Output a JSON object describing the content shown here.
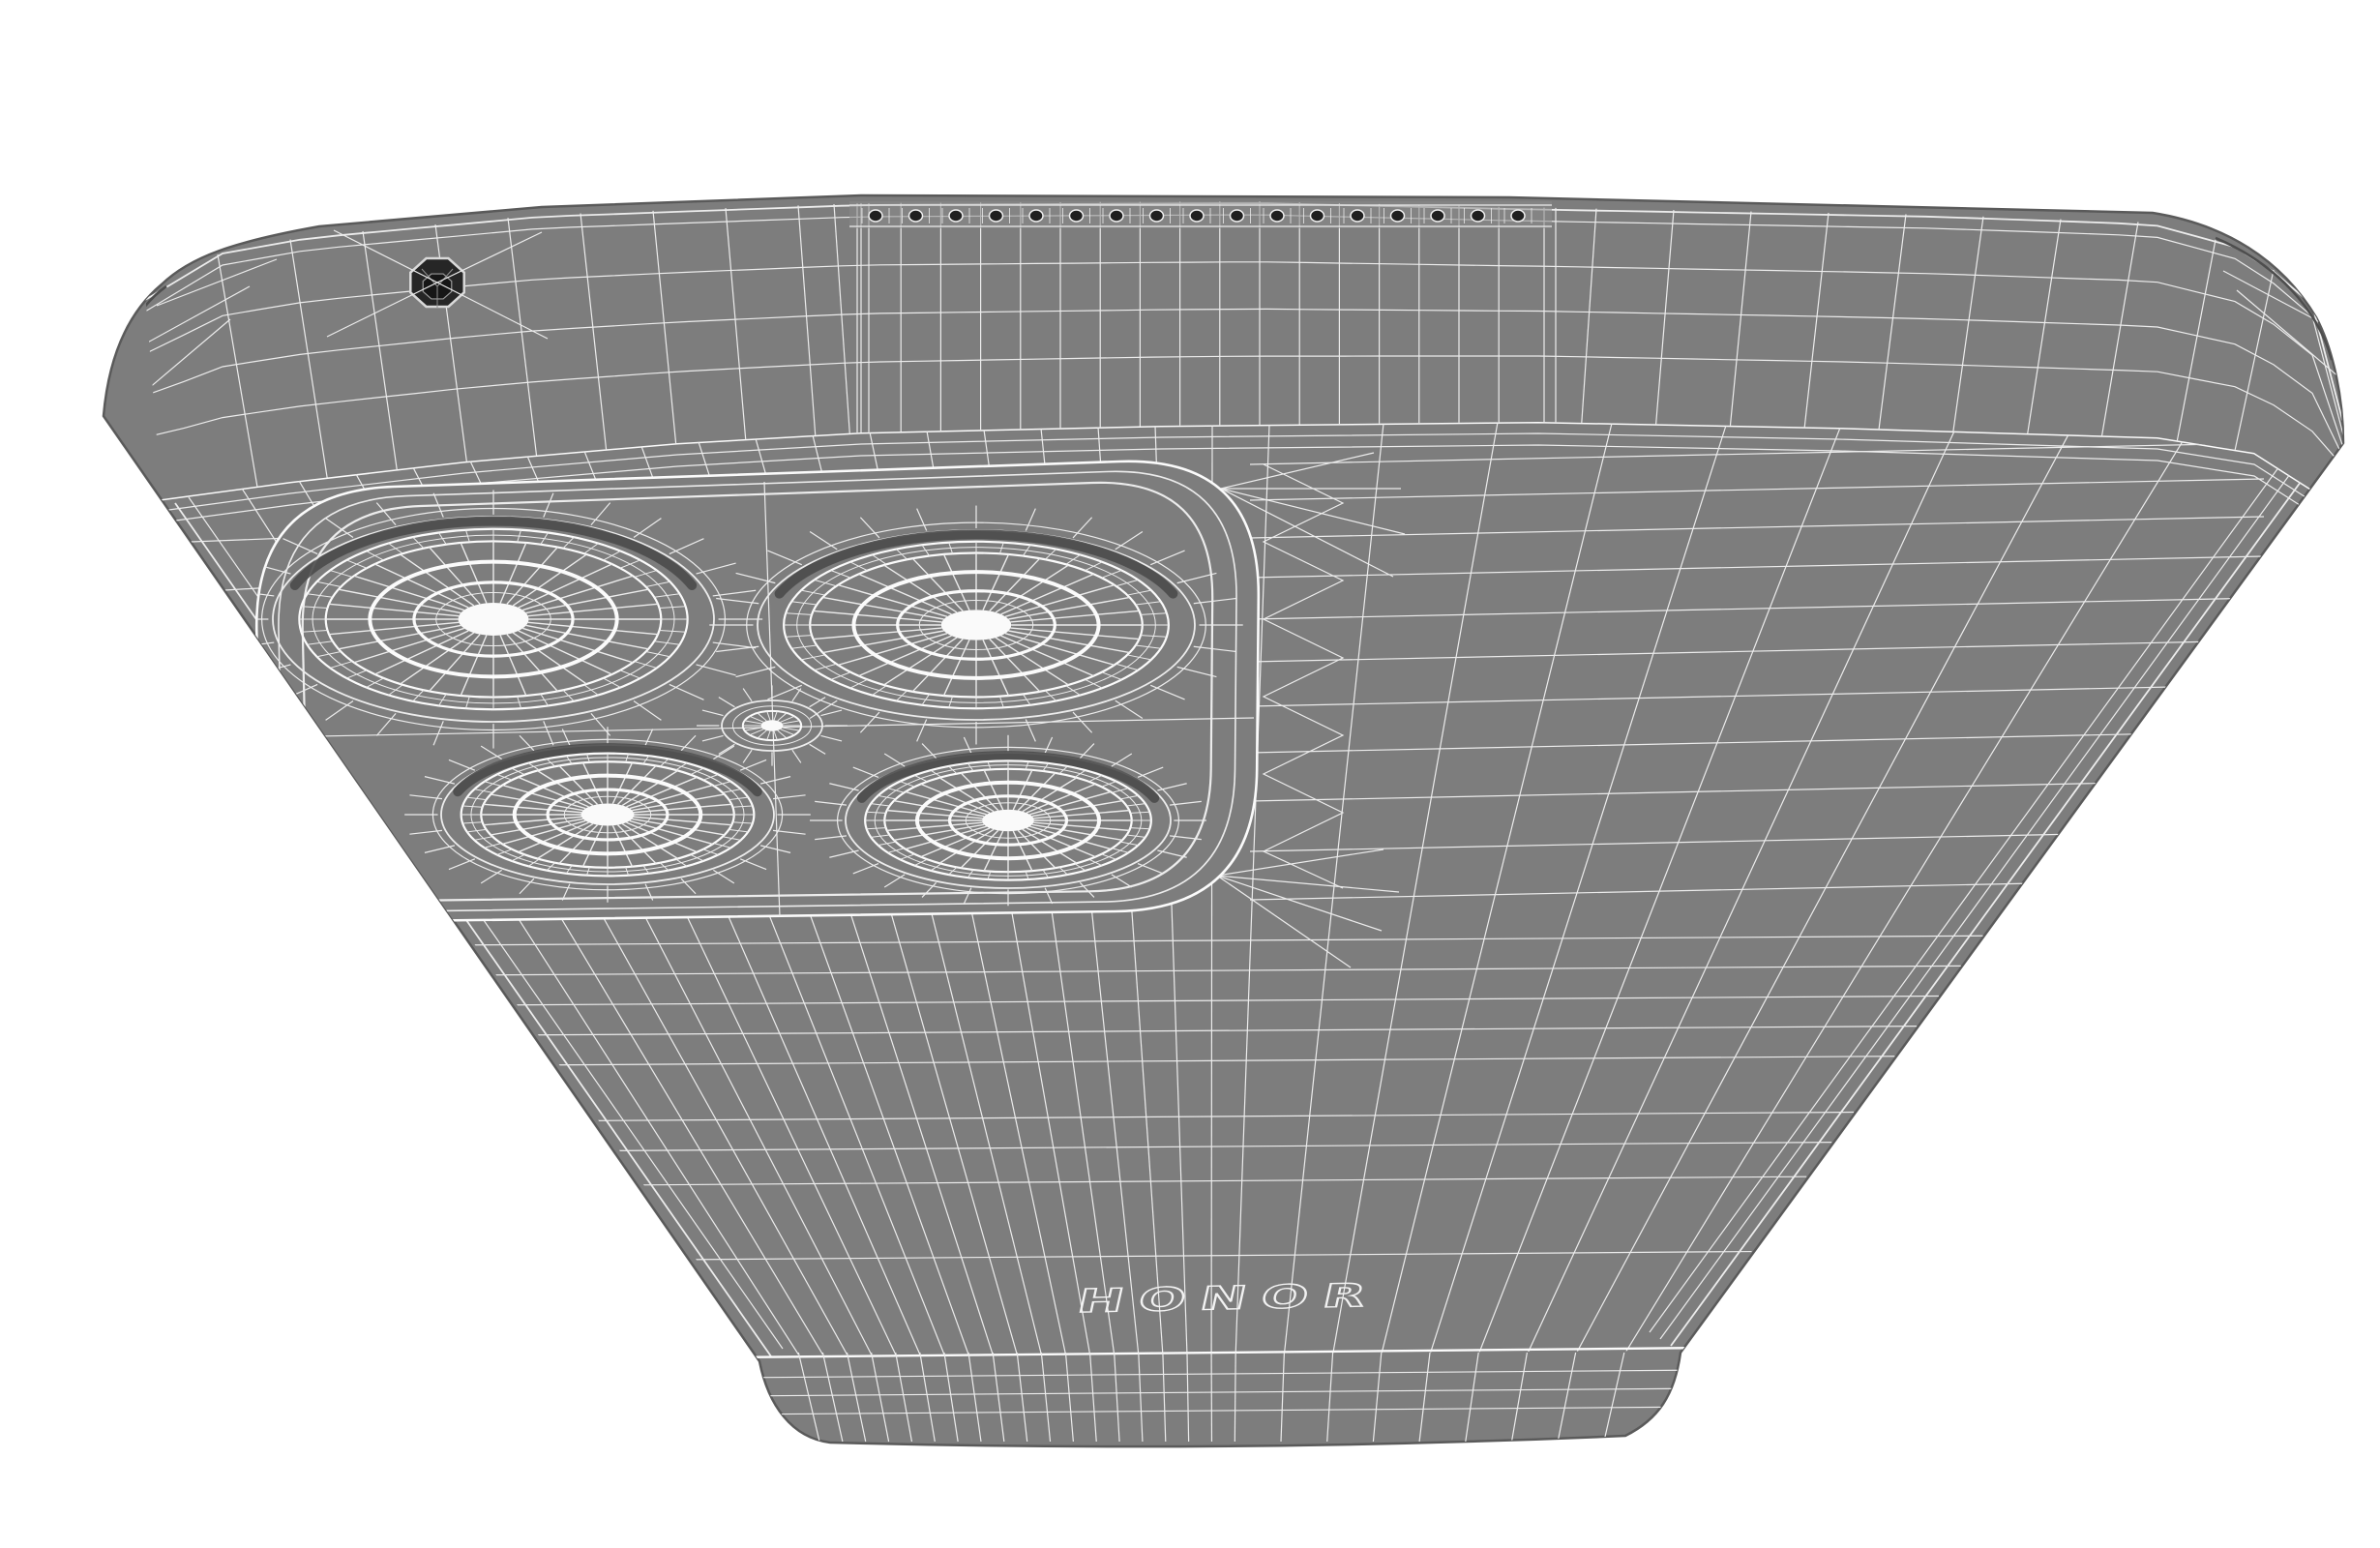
{
  "title": "HONOR smartphone back - 3D wireframe render",
  "scene": {
    "object": "smartphone-back-3d-wireframe",
    "view": "perspective-from-top-edge",
    "background_color": "#ffffff",
    "body_color": "#7d7d7d",
    "body_light": "#8b8b8b",
    "wire_color": "#ececec",
    "wire_bright_color": "#fbfbfb",
    "crease_color": "#4e4e4e",
    "recess_shadow_color": "#4b4b4b",
    "hole_color": "#1f1f1f",
    "lens_center_color": "#fafafa"
  },
  "device": {
    "brand_logo": "HONOR",
    "camera_module": {
      "large_lenses": 4,
      "small_sensors": 1
    },
    "top_edge": {
      "speaker_holes": 17,
      "mic_holes": 1
    }
  }
}
